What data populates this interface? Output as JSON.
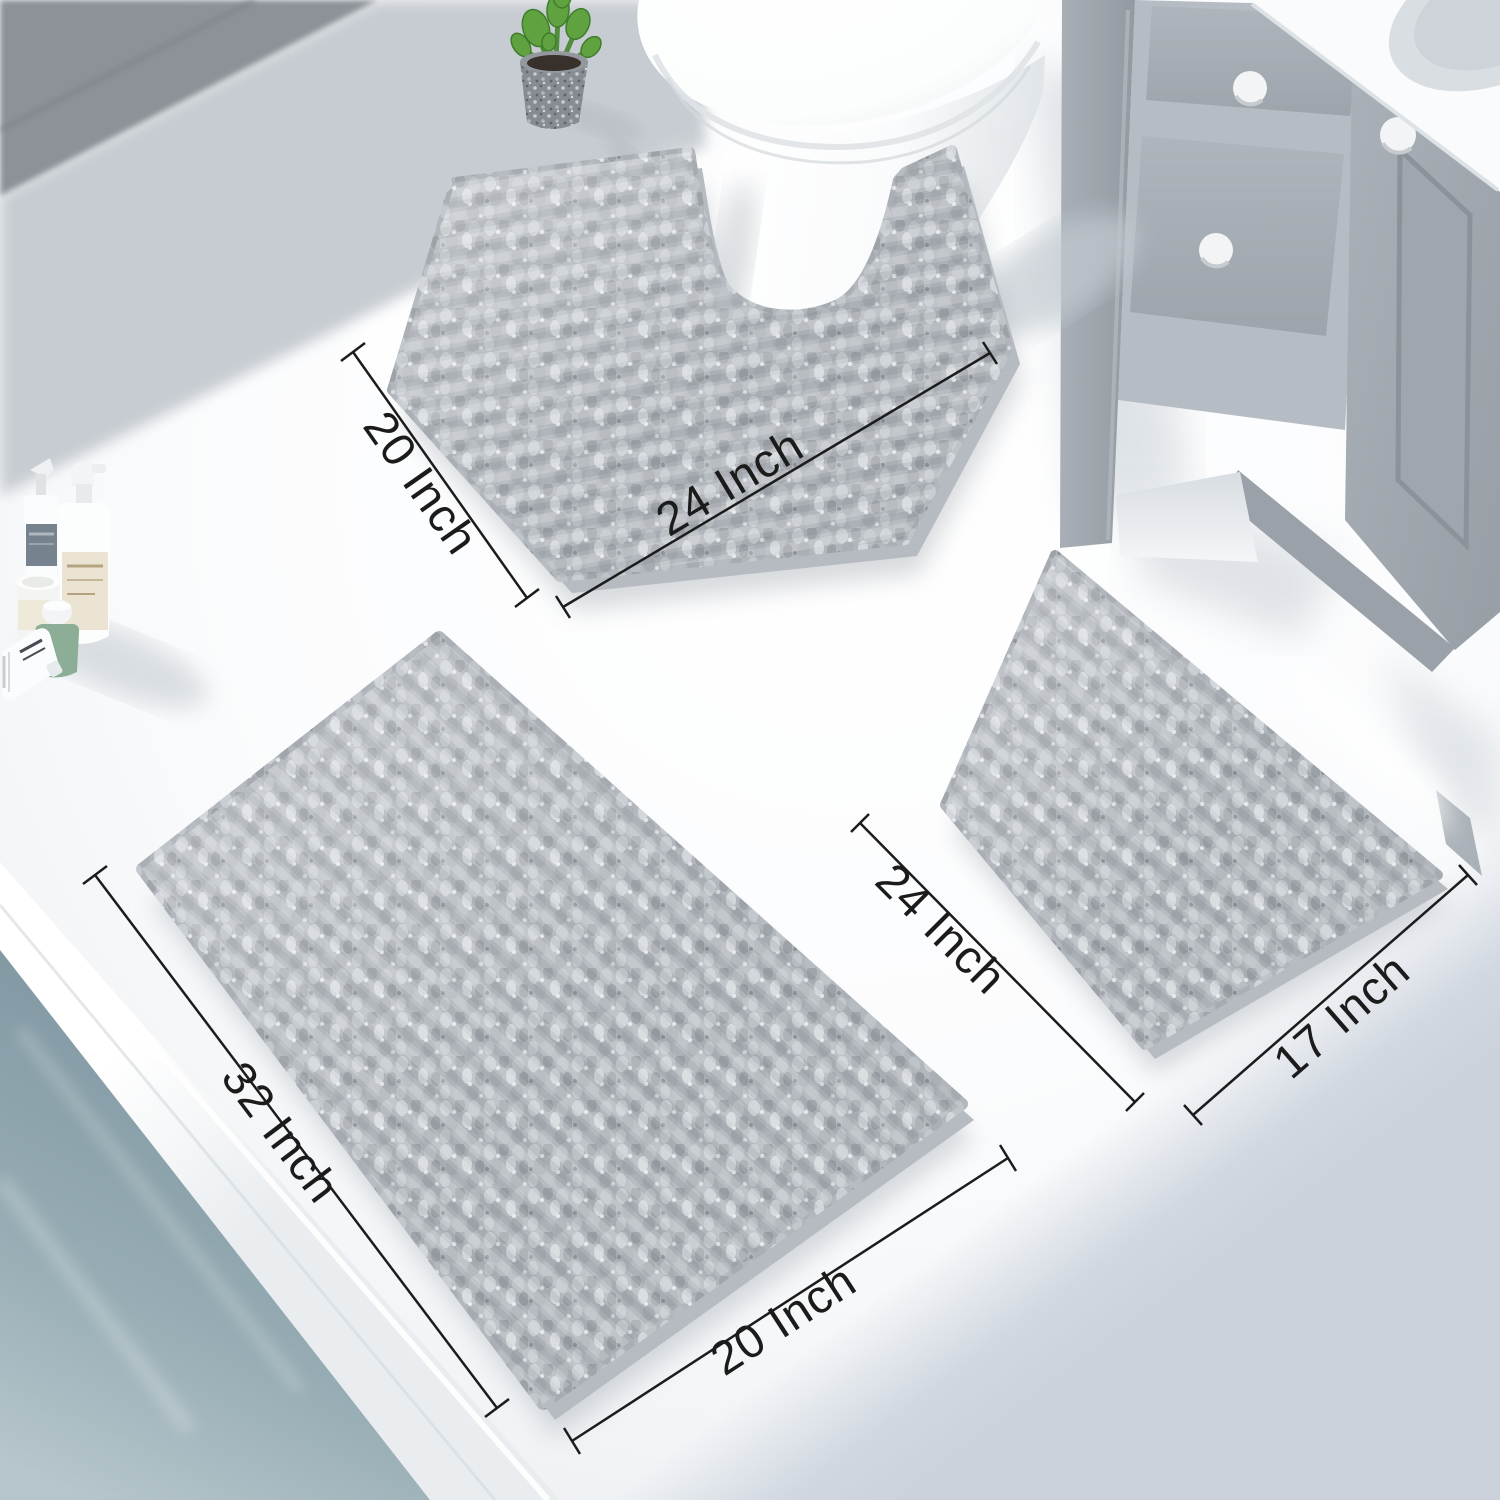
{
  "scene": {
    "alt": "Bathroom scene with grey chenille bath mat 3-piece set: contour toilet mat, large rug and small rug with size annotations"
  },
  "annotations": {
    "contour_mat": {
      "width_label": "20 Inch",
      "depth_label": "24 Inch"
    },
    "large_mat": {
      "length_label": "32 Inch",
      "width_label": "20 Inch"
    },
    "small_mat": {
      "length_label": "24 Inch",
      "width_label": "17 Inch"
    }
  },
  "colors": {
    "floor": "#f5f7f9",
    "wall_dark": "#8d9298",
    "wall_light": "#c7ccd2",
    "mat_base": "#b2b7bd",
    "mat_backing": "#b6bbc1",
    "water": "#879ca7",
    "vanity_body": "#9ba2a9",
    "vanity_drawer": "#a8afb6",
    "plant_green": "#5fa23f",
    "pot_gray": "#878c92",
    "toilet_white": "#fdfefe",
    "shadow_blue": "#cbd2dc",
    "dimension_line": "#1c1c1c",
    "dimension_text": "#1b1b1b"
  }
}
